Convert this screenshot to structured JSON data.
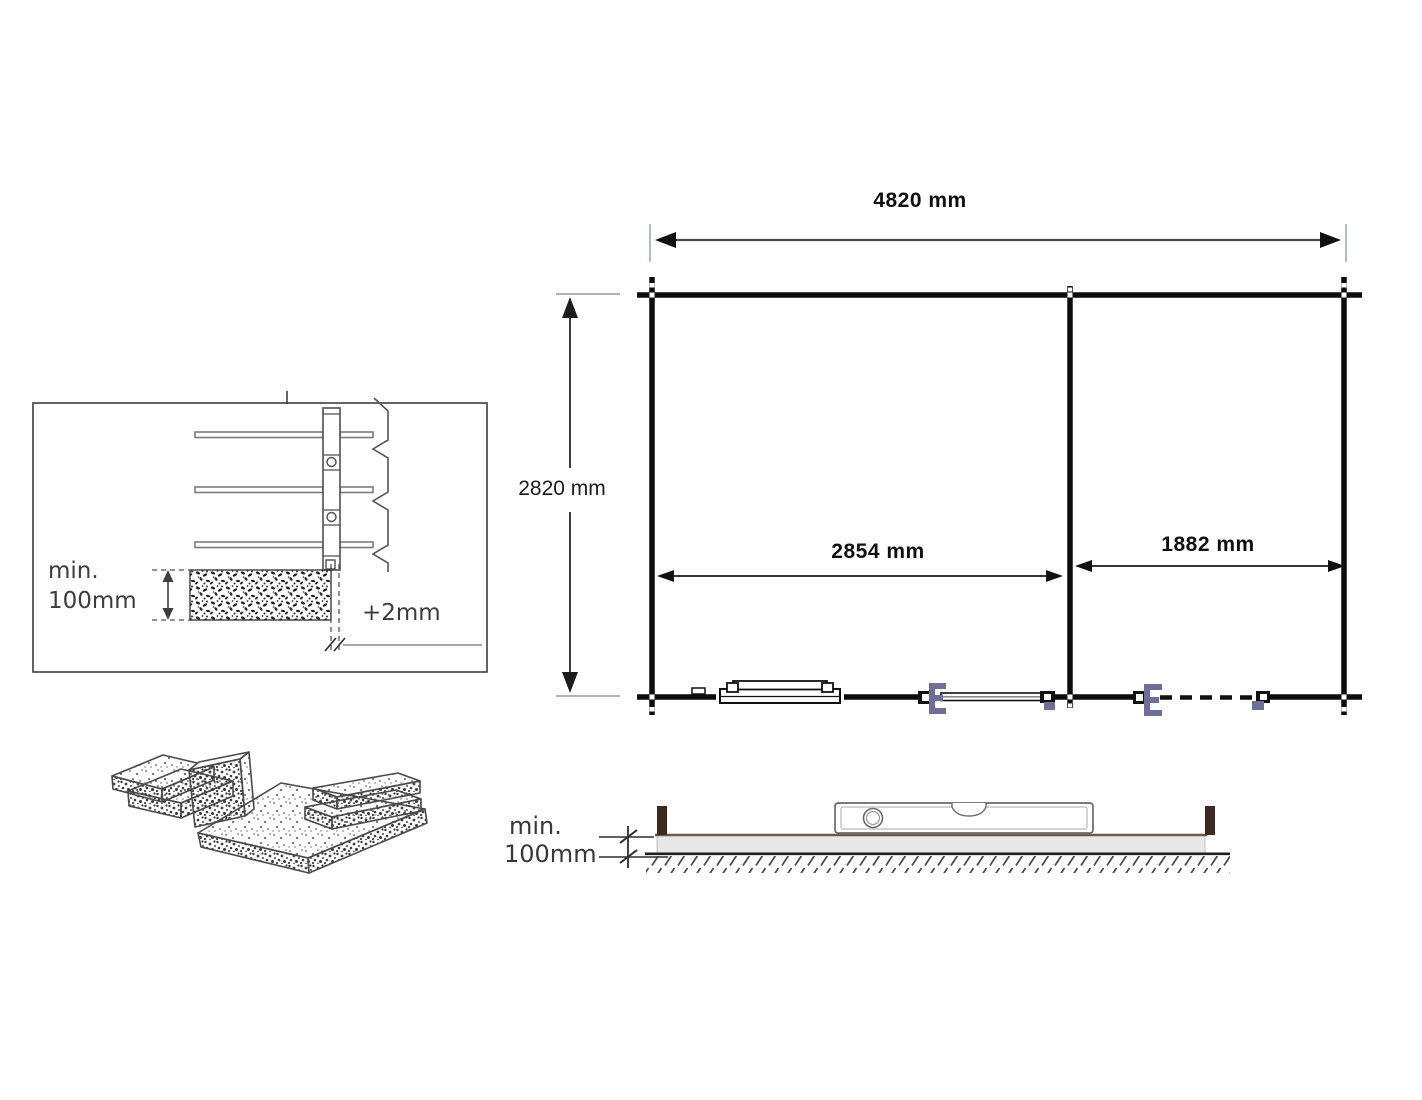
{
  "floor_plan": {
    "overall_width": "4820 mm",
    "overall_depth": "2820 mm",
    "left_room_width": "2854 mm",
    "right_room_width": "1882 mm"
  },
  "wall_detail": {
    "min_label": "min.",
    "min_value": "100mm",
    "tolerance": "+2mm"
  },
  "side_view": {
    "min_label": "min.",
    "min_value": "100mm"
  },
  "colors": {
    "wall": "#0c0c0c",
    "hinge": "#6e6e99",
    "post": "#3d2b20",
    "slab": "#e7e7e7",
    "ext": "#aab3c6"
  }
}
